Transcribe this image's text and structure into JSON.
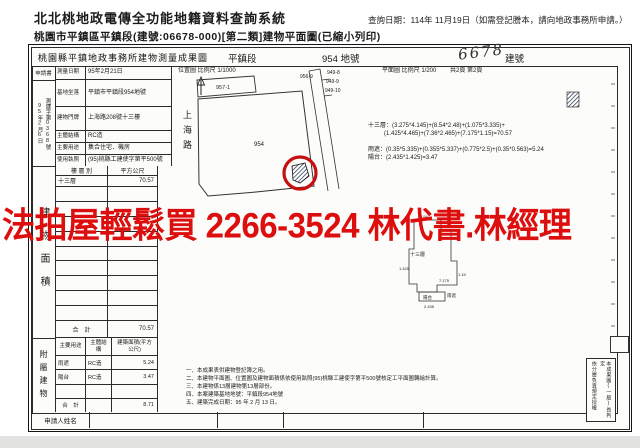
{
  "header": {
    "system_title": "北北桃地政電傳全功能地籍資料查詢系統",
    "query_date": "查詢日期：114年 11月19日（如需登記謄本，請向地政事務所申請。）",
    "doc_title": "桃園市平鎮區平鎮段(建號:06678-000)[第二類]建物平面圖(已縮小列印)"
  },
  "watermark": "法拍屋輕鬆買  2266-3524  林代書.林經理",
  "watermark_color": "#dd0e0e",
  "sheet": {
    "title": "桃園縣平鎮地政事務所建物測量成果圖",
    "section": "平鎮段",
    "parcel_no": "954 地號",
    "building_no": "6678",
    "building_no_label": "建號",
    "location_map_label": "位置圖 比例尺 1/1000",
    "floor_plan_label": "平面圖 比例尺 1/200",
    "page_info": "共2頁 第2頁",
    "margin": {
      "application": "申請書",
      "case_no": "測建字第0368號",
      "date": "95年2月6日",
      "area_section": "建物面積",
      "accessory_section": "附屬建物",
      "applicant": "申請人姓名"
    },
    "info_table": {
      "rows": [
        {
          "label": "測量日期",
          "value": "95年2月21日"
        },
        {
          "label": "基地坐落",
          "value": "平鎮市平鎮段954地號"
        },
        {
          "label": "建物門牌",
          "value": "上海路208號十三樓"
        },
        {
          "label": "主體結構",
          "value": "RC造"
        },
        {
          "label": "主要用途",
          "value": "集合住宅．機房"
        },
        {
          "label": "使用執照",
          "value": "(95)桃縣工建使字第平500號"
        }
      ]
    },
    "area_table": {
      "col1": "樓 層 別",
      "col2": "平方公尺",
      "row_floor": "十三層",
      "row_value": "70.57",
      "total_label": "合　計",
      "total_value": "70.57"
    },
    "accessory_table": {
      "col1": "主要用途",
      "col2": "主體結構",
      "col3": "建築面積(平方公尺)",
      "rows": [
        {
          "use": "雨遮",
          "structure": "RC造",
          "area": "5.24"
        },
        {
          "use": "陽台",
          "structure": "RC造",
          "area": "3.47"
        }
      ],
      "total_label": "合　計",
      "total_value": "8.71"
    },
    "map": {
      "road": "上海路",
      "parcels": {
        "p957": "957-1",
        "p954": "954",
        "p956": "956-9",
        "p949a": "949-8",
        "p949b": "949-9",
        "p949c": "949-10"
      },
      "formulas": [
        "十三層：(3.275*4.145)+(8.54*2.48)+(1.075*3.335)+",
        "(1.425*4.465)+(7.36*2.465)+(7.175*1.15)=70.57",
        "雨遮：(0.35*5.335)+(0.355*5.337)+(0.775*2.5)+(0.35*0.563)=5.24",
        "陽台：(2.435*1.425)=3.47"
      ],
      "plan": {
        "floor": "十三層",
        "balcony": "陽台",
        "canopy": "雨遮",
        "dims": [
          "8.54",
          "2.48",
          "1.425",
          "1.15",
          "7.175",
          "2.435"
        ]
      }
    },
    "notes": [
      "一、本成果表供建物登記簿之用。",
      "二、本建物平面圖、位置圖及建物面積係依使用執照(95)桃縣工建使字第平500號核定工平面圖轉繪計算。",
      "三、本建物係13層建物第13層部份。",
      "四、本案建築基地地號：平鎮段954地號",
      "五、建築完成日期：95 年 2 月 13 日。"
    ],
    "stamp": {
      "right_col": "本成果圖(一般)長判定",
      "left_col": "依分層負責規定授權"
    }
  }
}
